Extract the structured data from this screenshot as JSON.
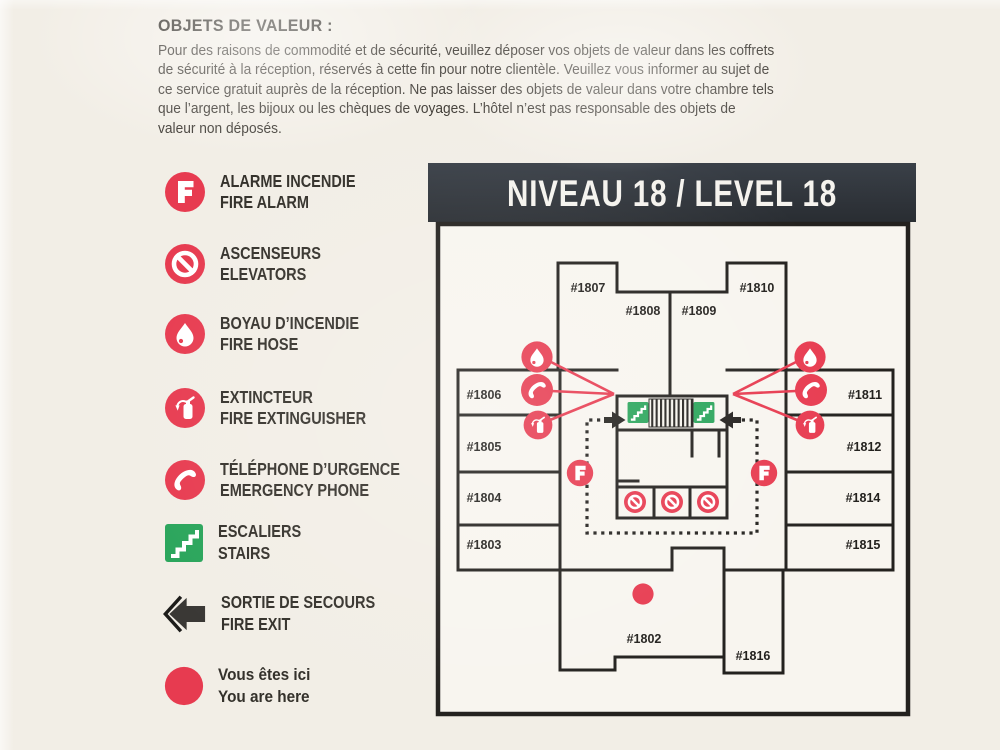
{
  "notice": {
    "heading": "OBJETS DE VALEUR :",
    "body_lines": [
      "Pour des raisons de commodité et de sécurité, veuillez déposer vos objets de valeur dans les coffrets",
      "de sécurité à la réception, réservés à cette fin pour notre clientèle. Veuillez vous informer au sujet de",
      "ce service gratuit auprès de la réception. Ne pas laisser des objets de valeur dans votre chambre tels",
      "que l’argent, les bijoux ou les chèques de voyages. L’hôtel n’est pas responsable des objets de",
      "valeur non déposés."
    ]
  },
  "legend": {
    "items": [
      {
        "id": "fire-alarm",
        "fr": "ALARME INCENDIE",
        "en": "FIRE ALARM",
        "icon": "fire-alarm-icon",
        "color": "#e73b50"
      },
      {
        "id": "elevators",
        "fr": "ASCENSEURS",
        "en": "ELEVATORS",
        "icon": "no-elevator-icon",
        "color": "#e73b50"
      },
      {
        "id": "fire-hose",
        "fr": "BOYAU D’INCENDIE",
        "en": "FIRE HOSE",
        "icon": "fire-hose-icon",
        "color": "#e73b50"
      },
      {
        "id": "fire-extinguisher",
        "fr": "EXTINCTEUR",
        "en": "FIRE EXTINGUISHER",
        "icon": "fire-extinguisher-icon",
        "color": "#e73b50"
      },
      {
        "id": "emergency-phone",
        "fr": "TÉLÉPHONE D’URGENCE",
        "en": "EMERGENCY PHONE",
        "icon": "emergency-phone-icon",
        "color": "#e73b50"
      },
      {
        "id": "stairs",
        "fr": "ESCALIERS",
        "en": "STAIRS",
        "icon": "stairs-icon",
        "color": "#2aa55b"
      },
      {
        "id": "fire-exit",
        "fr": "SORTIE DE SECOURS",
        "en": "FIRE EXIT",
        "icon": "fire-exit-arrow-icon",
        "color": "#3a3835"
      },
      {
        "id": "you-are-here",
        "fr": "Vous êtes ici",
        "en": "You are here",
        "icon": "you-are-here-icon",
        "color": "#e73b50"
      }
    ]
  },
  "map": {
    "title": "NIVEAU 18 / LEVEL 18",
    "rooms": [
      "#1807",
      "#1808",
      "#1809",
      "#1810",
      "#1806",
      "#1805",
      "#1804",
      "#1803",
      "#1811",
      "#1812",
      "#1814",
      "#1815",
      "#1802",
      "#1816"
    ]
  },
  "colors": {
    "accent_red": "#e73b50",
    "stairs_green": "#2aa55b",
    "wall_black": "#23211e",
    "titlebar_dark": "#31363d",
    "paper_cream": "#f2eee6",
    "ink": "#3b3833"
  }
}
